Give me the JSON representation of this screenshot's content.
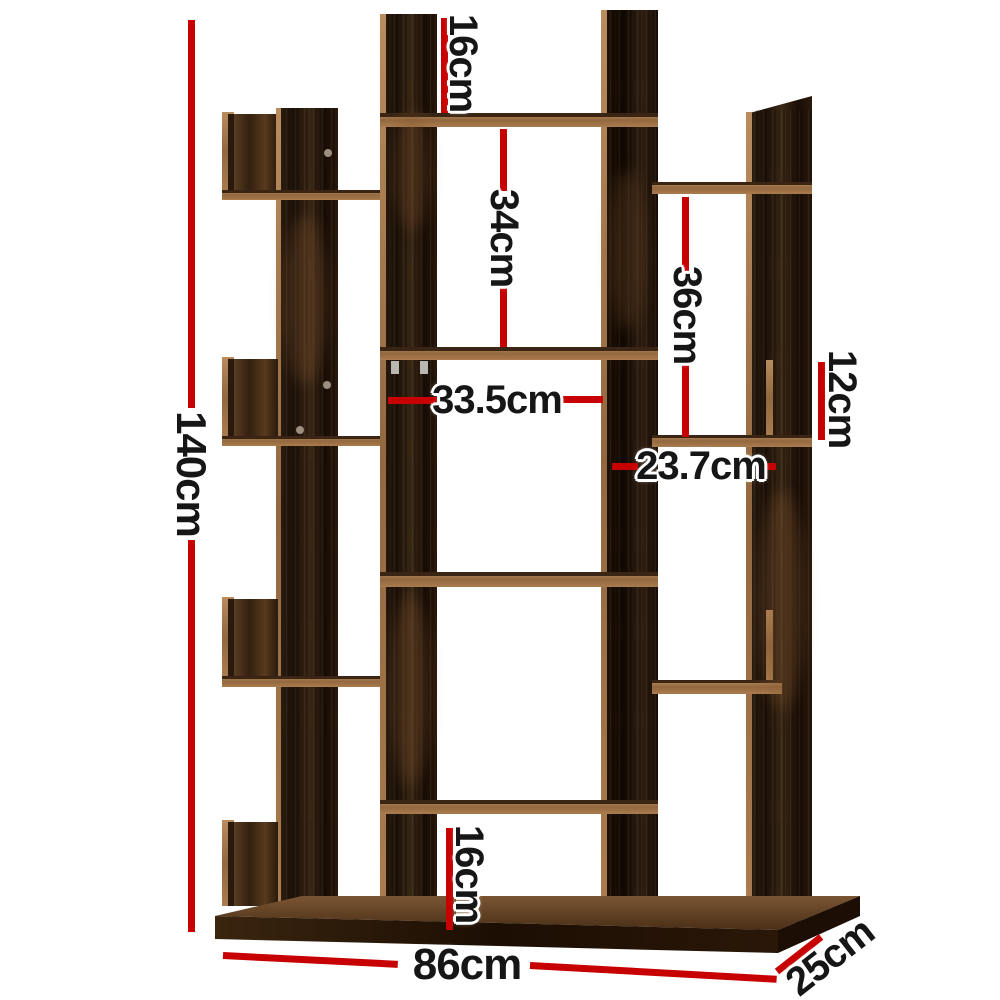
{
  "illustration": {
    "name": "tree-style-dark-wood-bookshelf",
    "style": "annotated product dimension diagram"
  },
  "labels": {
    "height": "140cm",
    "top_opening": "16cm",
    "upper_middle_opening": "34cm",
    "right_opening": "36cm",
    "right_small_opening": "12cm",
    "middle_width": "33.5cm",
    "right_width": "23.7cm",
    "bottom_opening": "16cm",
    "overall_width": "86cm",
    "depth": "25cm"
  },
  "colors": {
    "dimension_line_red": "#c70101",
    "label_text": "#161616",
    "label_halo": "#ffffff",
    "wood_dark": "#241509",
    "wood_rust": "#5a3d22",
    "wood_edge_light": "#a87c50",
    "background": "#ffffff"
  }
}
